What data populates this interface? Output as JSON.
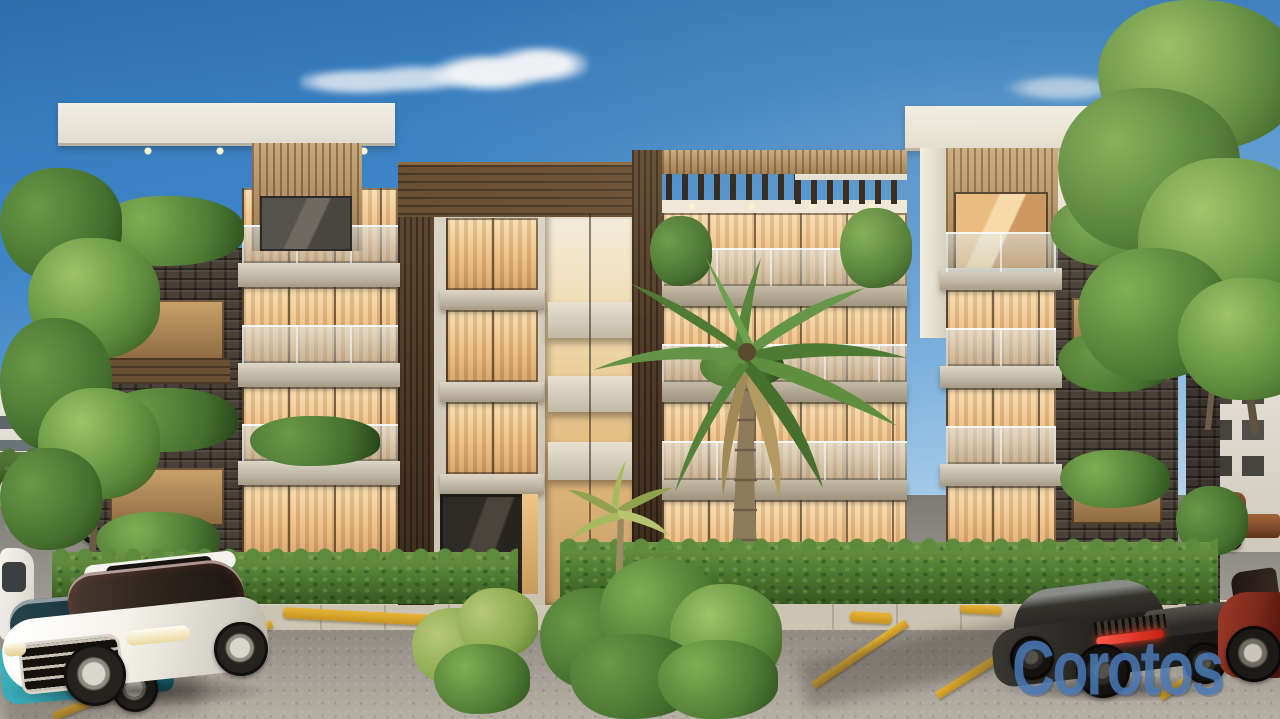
{
  "scene": {
    "description": "Photorealistic rendering of a modern four-story apartment building with white concrete, wood-slat and dark stone facade, lush landscaping and luxury cars parked in the front lot",
    "sky": "clear blue with small white clouds",
    "building": {
      "floors": 4,
      "sections": [
        "left-wing",
        "central-tower",
        "atrium",
        "center-block",
        "right-wing"
      ],
      "features": [
        "cantilevered white roof slabs",
        "wood slat panels",
        "roof pergola",
        "glass balcony railings",
        "dark stone planter columns",
        "warm lit interiors",
        "hedge row",
        "central entrance walkway"
      ]
    },
    "vehicles": [
      {
        "name": "white-luxury-sedan",
        "color": "#f2f0ea",
        "location": "front parking left"
      },
      {
        "name": "teal-sedan",
        "color": "#2b93a2",
        "location": "far left behind sedan"
      },
      {
        "name": "white-parked-car",
        "color": "#eceae4",
        "location": "left edge"
      },
      {
        "name": "silver-suv",
        "color": "#b4b8bd",
        "location": "street background left"
      },
      {
        "name": "black-sports-coupe",
        "color": "#26241f",
        "location": "front parking right"
      },
      {
        "name": "maroon-sports-car",
        "color": "#7e2a1d",
        "location": "right edge"
      },
      {
        "name": "brown-pickup-truck",
        "color": "#7c4b2b",
        "location": "street background right"
      }
    ],
    "landscaping": [
      "street tree left",
      "large tree right",
      "tall palm tree center",
      "small palm at walkway",
      "boxwood hedge",
      "fern shrubs",
      "planter plants"
    ]
  },
  "watermark": {
    "text": "Corotos",
    "color": "#4a79b6"
  },
  "palette": {
    "sky_top": "#2f74b5",
    "sky_horizon": "#c3dcf0",
    "facade_white": "#f2eee4",
    "facade_shadow": "#d8d2c4",
    "wood_light": "#b3905f",
    "wood_dark": "#4e3722",
    "stone_dark": "#3f362d",
    "window_glow": "#ecbd83",
    "hedge_green": "#507c33",
    "palm_green": "#5d8a3c",
    "asphalt_grey": "#a29c92",
    "sidewalk": "#ccc4b2",
    "parking_marking_yellow": "#d8a62a",
    "taillight_red": "#e02a18"
  }
}
